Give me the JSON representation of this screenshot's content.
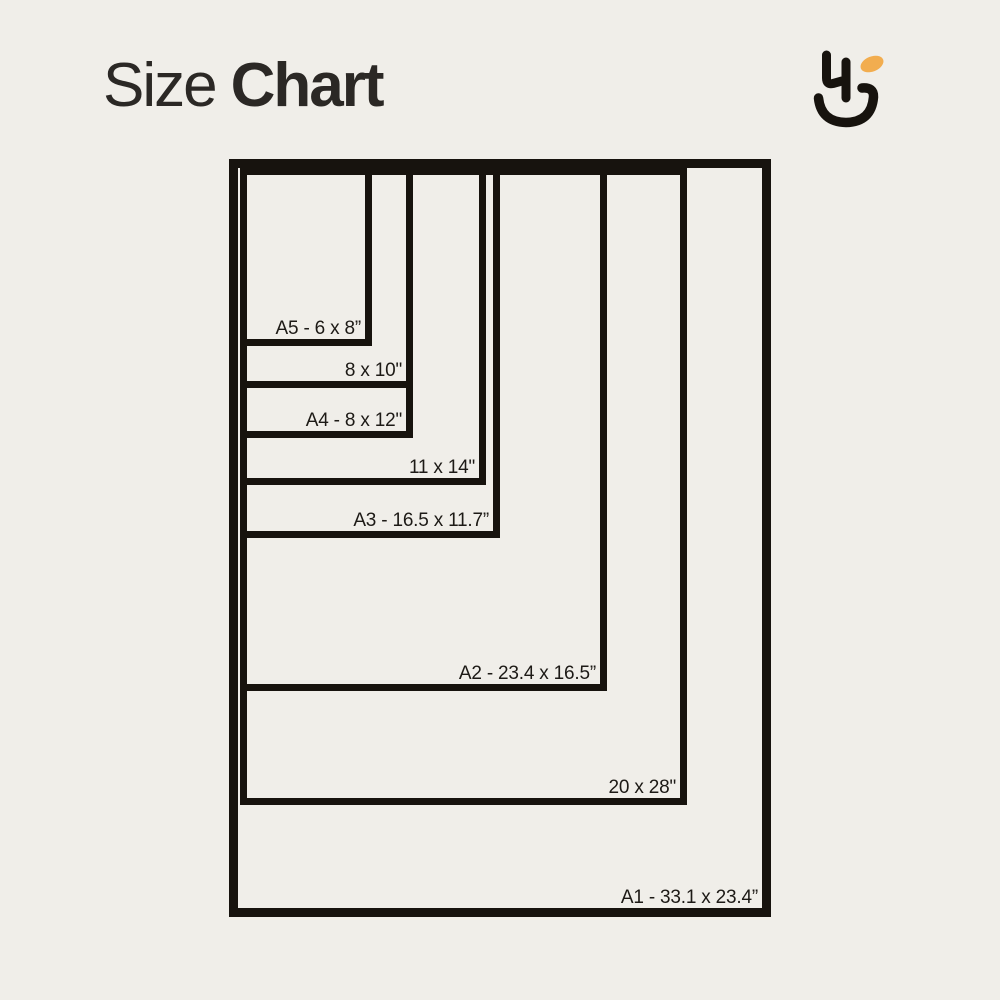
{
  "background_color": "#f0eee9",
  "title": {
    "regular": "Size",
    "bold": "Chart",
    "color": "#2b2825"
  },
  "logo": {
    "name": "hj-monogram-smile-logo",
    "stroke_color": "#17130e",
    "accent_color": "#f2ad4f"
  },
  "chart_data": {
    "type": "nested-rectangles-size-chart",
    "title": "Size Chart",
    "unit": "inches",
    "line_color": "#17130e",
    "outer_border_px": 9,
    "inner_border_px": 7,
    "label_color": "#1d1a16",
    "sizes": [
      {
        "name": "A1",
        "label": "A1 - 33.1 x 23.4”",
        "dimensions_text": "33.1 x 23.4”",
        "box": {
          "left": 229,
          "top": 159,
          "width": 542,
          "height": 758
        },
        "border_px": 9
      },
      {
        "name": "20x28",
        "label": "20 x 28\"",
        "dimensions_text": "20 x 28\"",
        "box": {
          "left": 240,
          "top": 168,
          "width": 447,
          "height": 637
        },
        "border_px": 7
      },
      {
        "name": "A2",
        "label": "A2 - 23.4 x 16.5”",
        "dimensions_text": "23.4 x 16.5”",
        "box": {
          "left": 240,
          "top": 168,
          "width": 367,
          "height": 523
        },
        "border_px": 7
      },
      {
        "name": "A3",
        "label": "A3 - 16.5 x 11.7”",
        "dimensions_text": "16.5 x 11.7”",
        "box": {
          "left": 240,
          "top": 168,
          "width": 260,
          "height": 370
        },
        "border_px": 7
      },
      {
        "name": "11x14",
        "label": "11 x 14\"",
        "dimensions_text": "11 x 14\"",
        "box": {
          "left": 240,
          "top": 168,
          "width": 246,
          "height": 317
        },
        "border_px": 7
      },
      {
        "name": "A4",
        "label": "A4 - 8 x 12\"",
        "dimensions_text": "8 x 12\"",
        "box": {
          "left": 240,
          "top": 168,
          "width": 173,
          "height": 270
        },
        "border_px": 7
      },
      {
        "name": "8x10",
        "label": "8 x 10\"",
        "dimensions_text": "8 x 10\"",
        "box": {
          "left": 240,
          "top": 168,
          "width": 173,
          "height": 220
        },
        "border_px": 7
      },
      {
        "name": "A5",
        "label": "A5 - 6 x 8”",
        "dimensions_text": "6 x 8”",
        "box": {
          "left": 240,
          "top": 168,
          "width": 132,
          "height": 178
        },
        "border_px": 7
      }
    ]
  }
}
